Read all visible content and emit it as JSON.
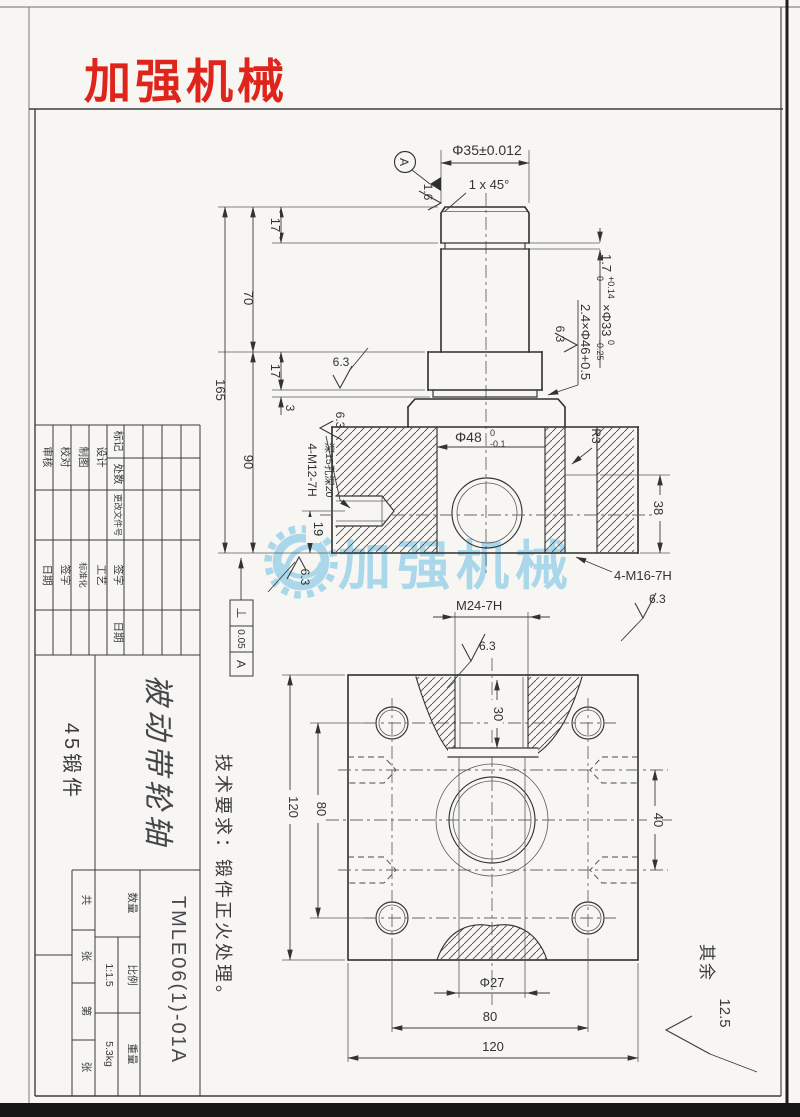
{
  "colors": {
    "brand_red": "#df241c",
    "watermark_blue": "#5fb9e4",
    "paper": "#f7f6f2"
  },
  "brand": {
    "logo": "加强机械"
  },
  "watermark": {
    "text": "加强机械"
  },
  "notes": {
    "tech": "技术要求：锻件正火处理。",
    "rest_label": "其余",
    "rest_value": "12.5"
  },
  "gdt": {
    "symbol": "⊥",
    "value": "0.05",
    "datum": "A"
  },
  "datum": {
    "label": "A"
  },
  "roughness": {
    "r16": "1.6",
    "r63": "6.3"
  },
  "dims": {
    "d35": "Φ35±0.012",
    "chamfer": "1 x 45°",
    "d349": "Φ34.9",
    "d48_main": "Φ48",
    "d48_sup": "0",
    "d48_sub": "-0.1",
    "g1_main": "1.7",
    "g1_sup": "+0.14",
    "g1_sub": "0",
    "g1_tail": "×Φ33",
    "g1_sup2": "0",
    "g1_sub2": "-0.25",
    "g2": "2.4×Φ46+0.5",
    "r3": "R3",
    "m12_1": "4-M12-7H",
    "m12_2": "深15孔深20",
    "m16": "4-M16-7H",
    "m24": "M24-7H",
    "d17": "17",
    "d70": "70",
    "d165": "165",
    "d3": "3",
    "d90": "90",
    "d19": "19",
    "d38": "38",
    "d30": "30",
    "d27": "Φ27",
    "d40": "40",
    "d80": "80",
    "d120": "120"
  },
  "title_block": {
    "rev_headers": [
      "标记",
      "处数",
      "更改文件号",
      "签字",
      "日期"
    ],
    "roles": [
      "审核",
      "校对",
      "制图",
      "设计"
    ],
    "procs": [
      "日期",
      "签字",
      "标准化",
      "工艺"
    ],
    "material": "45锻件",
    "part_name": "被动带轮轴",
    "drawing_no": "TMLE06(1)-01A",
    "sheet": [
      "共",
      "张",
      "第",
      "张"
    ],
    "qty_label": "数量",
    "scale_label": "比例",
    "scale_value": "1:1.5",
    "weight_label": "重量",
    "weight_value": "5.3kg"
  }
}
